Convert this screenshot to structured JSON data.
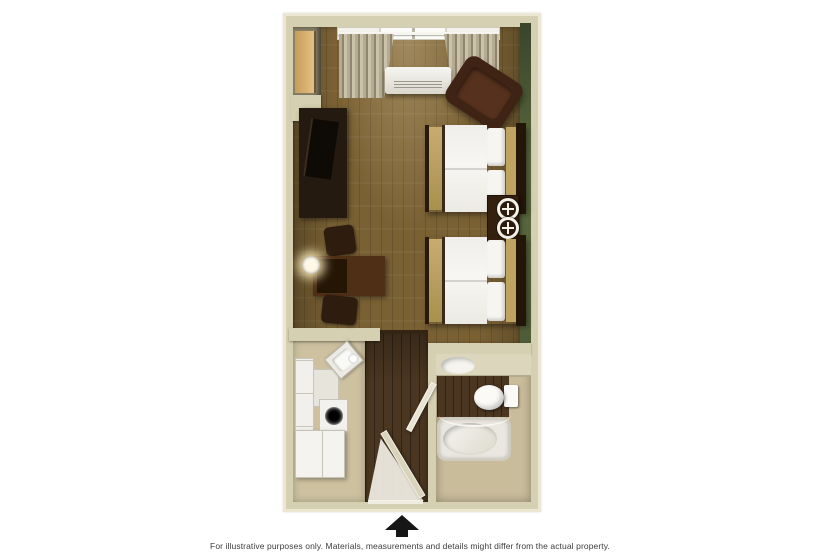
{
  "footer": {
    "disclaimer": "For illustrative purposes only.  Materials, measurements and details might differ from the actual property.",
    "entrance_marker_icon": "up-arrow-icon"
  },
  "floorplan": {
    "kind": "hotel studio room floor plan, top-down 3D render",
    "rooms": [
      "main-room",
      "kitchenette",
      "entry-hall",
      "bathroom"
    ],
    "accent_wall": "green",
    "furniture": {
      "main_room": [
        "closet",
        "tv-dresser",
        "desk",
        "desk-chair-upper",
        "desk-chair-lower",
        "wall-lamp",
        "window",
        "curtains",
        "ac-unit",
        "armchair",
        "double-bed-1",
        "double-bed-2",
        "nightstand",
        "table-lamp-1",
        "table-lamp-2"
      ],
      "kitchenette": [
        "cabinets",
        "corner-sink",
        "stove",
        "refrigerator"
      ],
      "bathroom": [
        "vanity-sink",
        "toilet",
        "bathtub",
        "shower-curtain-rod"
      ],
      "entry_hall": [
        "entry-door",
        "bathroom-door"
      ]
    }
  },
  "colors": {
    "canvas": "#ffffff",
    "wall": "#d6d0b2",
    "wall-highlight": "#ebe7d2",
    "accent-wall-green": "#4e5c38",
    "floor-wood": "#7a6134",
    "floor-wood-dark": "#4a3621",
    "floor-tile": "#cdc1a0",
    "bath-floor": "#c9bc9b",
    "fixture-white": "#f2f1ec",
    "arrow-black": "#161616",
    "disclaimer-text": "#3c3c3c"
  }
}
